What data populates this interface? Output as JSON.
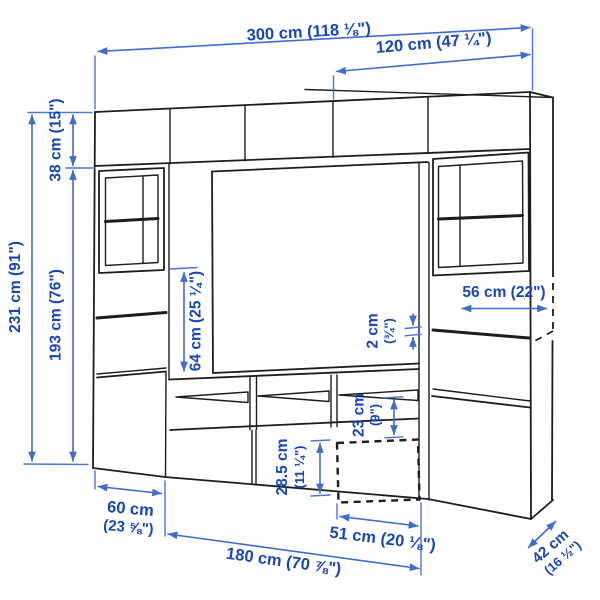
{
  "colors": {
    "background": "#ffffff",
    "furniture_line": "#1d1d1f",
    "dimension_line": "#3e6cd1",
    "dimension_text": "#1747b8"
  },
  "dimensions": {
    "total_width": "300 cm (118 ⅛\")",
    "upper_right_width": "120 cm (47 ¼\")",
    "top_cabinet_height": "38 cm (15\")",
    "total_height": "231 cm (91\")",
    "lower_section_height": "193 cm (76\")",
    "side_opening_height": "64 cm (25 ¼\")",
    "shelf_width": "56 cm (22\")",
    "gap": {
      "line1": "2 cm",
      "line2": "(¾\")"
    },
    "compartment_height": {
      "line1": "23 cm",
      "line2": "(9\")"
    },
    "drawer_front_height": {
      "line1": "28.5 cm",
      "line2": "(11 ¼\")"
    },
    "left_unit_width": {
      "line1": "60 cm",
      "line2": "(23 ⅝\")"
    },
    "drawer_width": "51 cm (20 ⅛\")",
    "bench_width": "180 cm (70 ⅞\")",
    "unit_depth": {
      "line1": "42 cm",
      "line2": "(16 ½\")"
    }
  }
}
